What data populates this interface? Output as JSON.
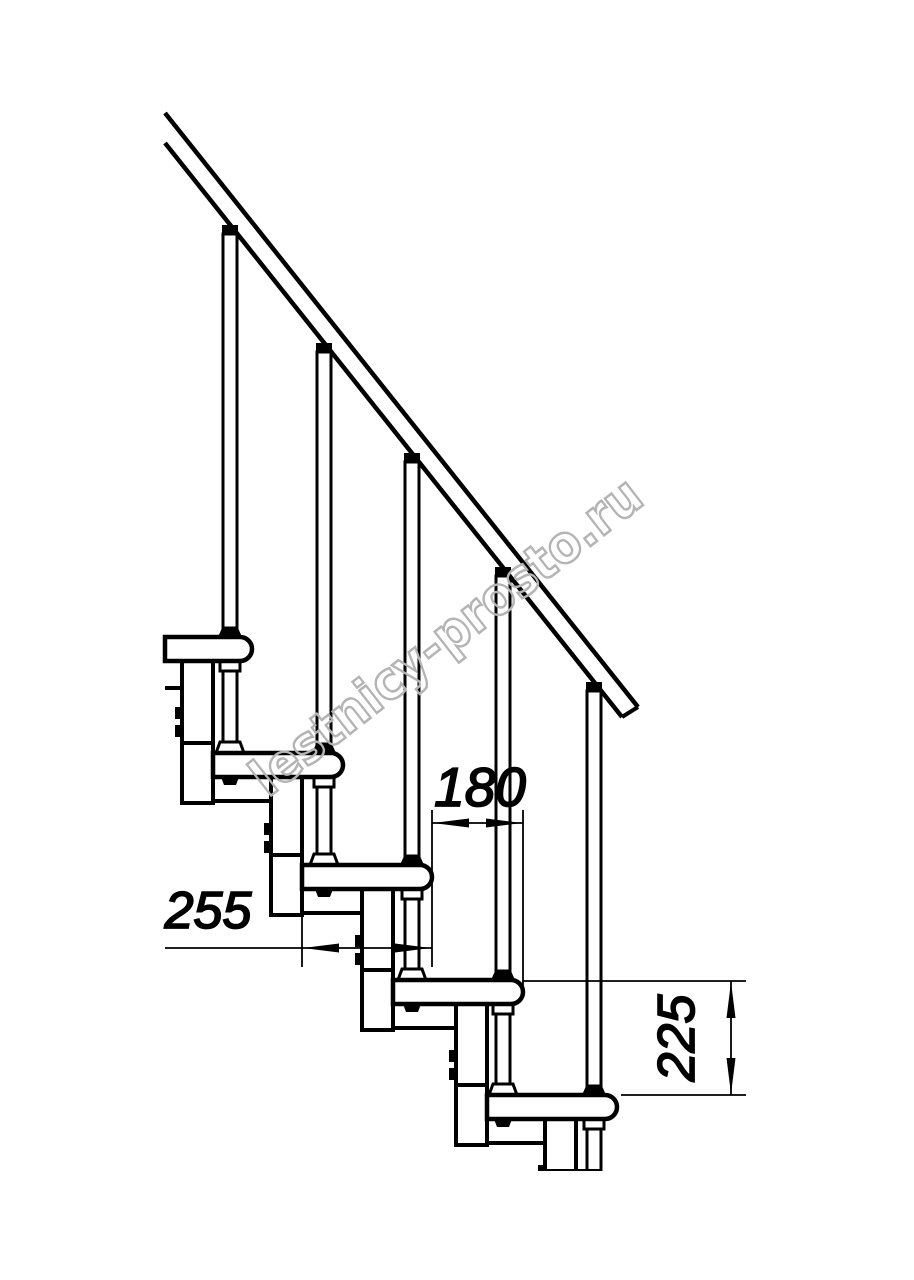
{
  "drawing": {
    "type": "modular-staircase-side-view-fragment",
    "dimensions": {
      "tread_depth_label": "255",
      "step_going_label": "180",
      "step_rise_label": "225"
    },
    "watermark_text": "lestnicy-prosto.ru",
    "colors": {
      "line": "#000000",
      "background": "#ffffff",
      "watermark_outline": "#b4b4b4"
    }
  }
}
